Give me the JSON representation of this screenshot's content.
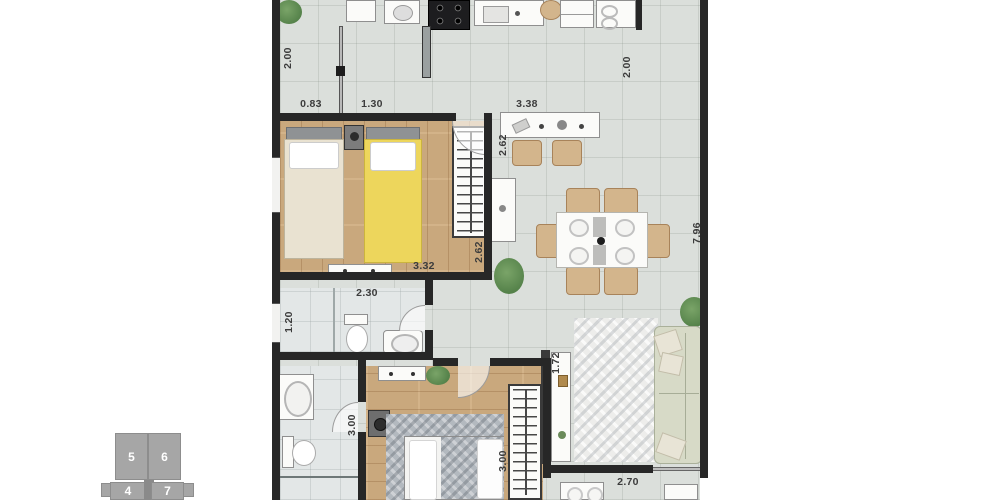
{
  "colors": {
    "wall": "#272727",
    "tile": "#dbdfdb",
    "bathTile": "#e3e7e7",
    "wood": "#c9a87d",
    "yellow": "#edd65c",
    "beige": "#e9e2d1",
    "sofa": "#d7dac7",
    "chair": "#d3b58c",
    "rugGray": "#b3b9bf",
    "rugWhite": "#ededeb",
    "keyplan": "#a6a6a6",
    "dim": "#3c3c3c",
    "plant": "#55824a",
    "fixture": "#fbfbf9"
  },
  "dimensions": {
    "kitchen_height": "2.00",
    "kitchen_seg_a": "0.83",
    "kitchen_seg_b": "1.30",
    "counter_width": "3.38",
    "service_height": "2.00",
    "plan_right_height": "7.96",
    "counter_side": "2.62",
    "bedroom1_width": "3.32",
    "bedroom1_depth": "2.62",
    "bath1_width": "2.30",
    "bath1_depth": "1.20",
    "bath2_height": "3.00",
    "bedroom2_height": "3.00",
    "tv_wall_height": "1.72",
    "balcony_width": "2.70"
  },
  "keyplan": {
    "units": [
      "5",
      "6",
      "4",
      "7"
    ]
  }
}
